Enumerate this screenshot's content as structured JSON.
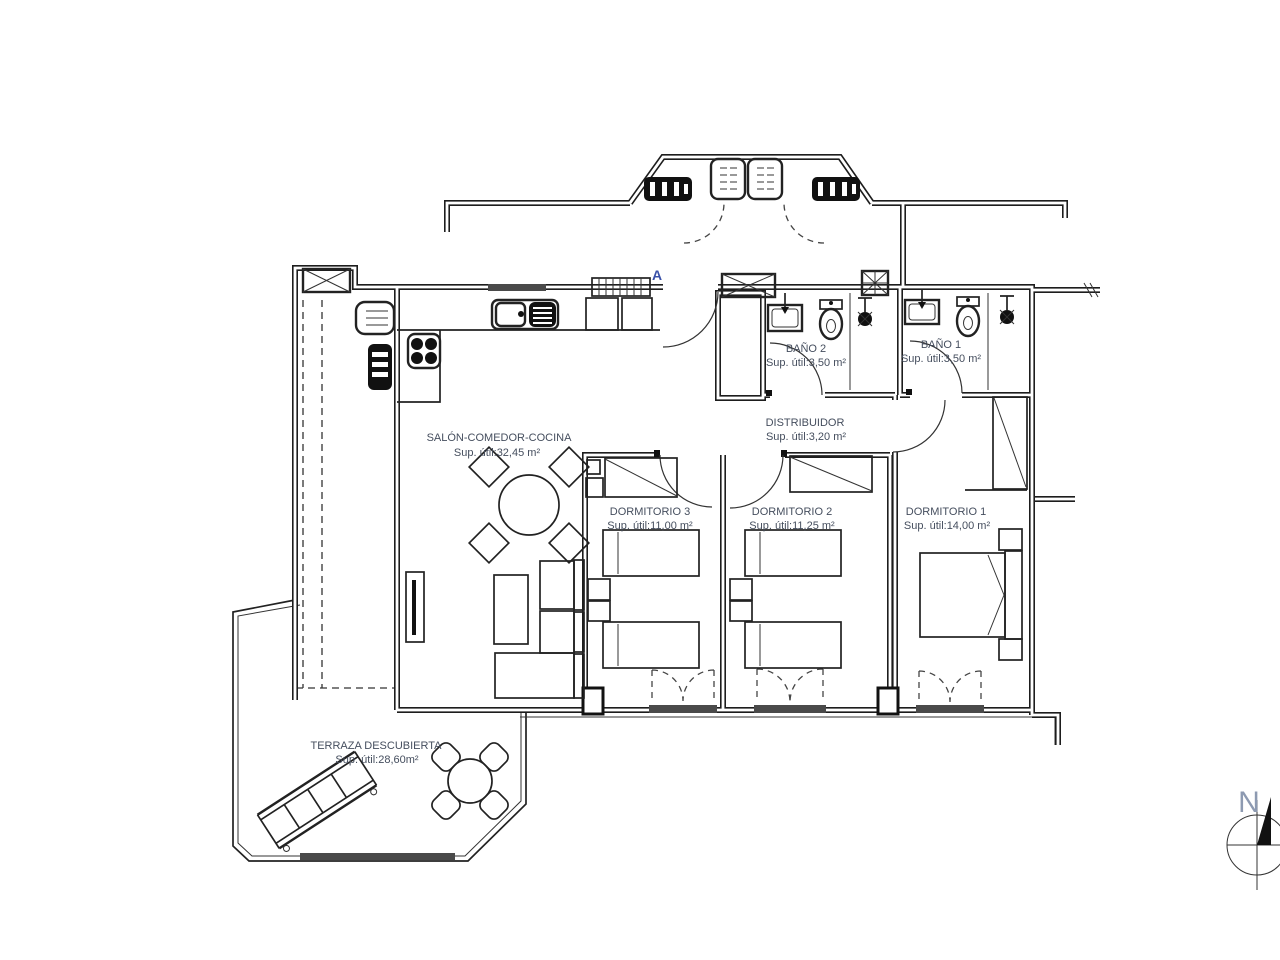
{
  "document": {
    "type": "architectural-floor-plan",
    "background": "#ffffff"
  },
  "colors": {
    "linework": "#1d1d1d",
    "label_text": "#454e5e",
    "section_letter": "#3950a8",
    "north_letter": "#8d9ab1",
    "window_sill": "#4a4a4a"
  },
  "section_marker": {
    "letter": "A"
  },
  "compass": {
    "letter": "N"
  },
  "rooms": [
    {
      "name": "SALÓN-COMEDOR-COCINA",
      "area": "Sup. útil:32,45 m²"
    },
    {
      "name": "BAÑO 2",
      "area": "Sup. útil:3,50 m²"
    },
    {
      "name": "BAÑO 1",
      "area": "Sup. útil:3,50 m²"
    },
    {
      "name": "DISTRIBUIDOR",
      "area": "Sup. útil:3,20 m²"
    },
    {
      "name": "DORMITORIO 3",
      "area": "Sup. útil:11,00 m²"
    },
    {
      "name": "DORMITORIO 2",
      "area": "Sup. útil:11,25 m²"
    },
    {
      "name": "DORMITORIO 1",
      "area": "Sup. útil:14,00 m²"
    },
    {
      "name": "TERRAZA DESCUBIERTA",
      "area": "Sup. útil:28,60m²"
    }
  ]
}
